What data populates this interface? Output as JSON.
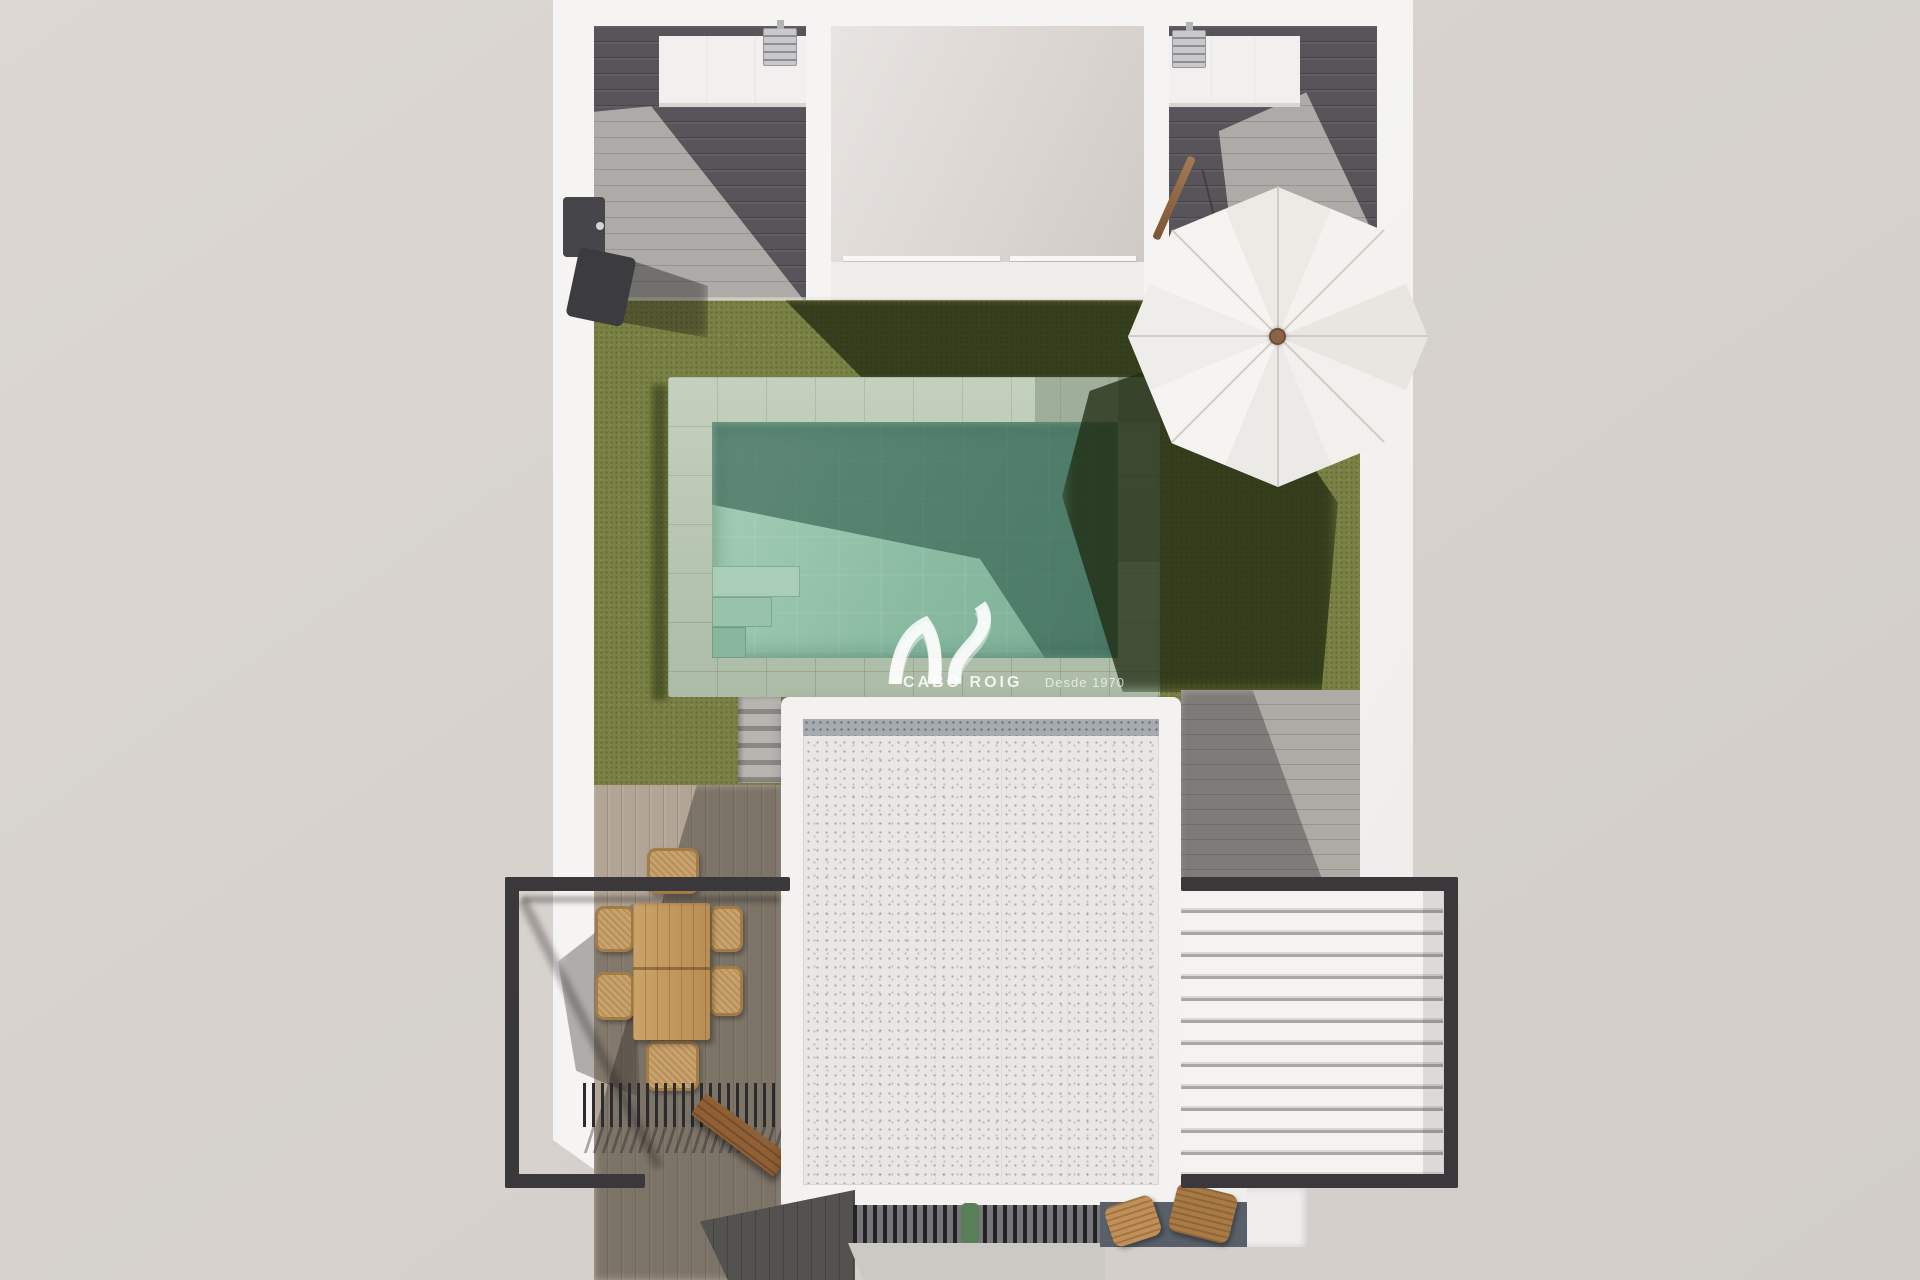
{
  "watermark": {
    "brand": "CABO ROIG",
    "tagline": "Desde 1970"
  },
  "scene": {
    "description": "Top-down 3D architectural render of a villa plot: U-shaped white building with roof decks, central courtyard, olive lawn with rectangular pool, white parasol, speckled rooftop, black glass railings, white louvered pergola, outdoor dining set, slatted grills and an outdoor shower",
    "objects": [
      "white-building-walls",
      "dark-wood-roof-deck-left",
      "dark-wood-roof-deck-right",
      "rooftop-counter-left",
      "rooftop-counter-right",
      "ac-unit-left",
      "ac-unit-right",
      "central-courtyard-terrace",
      "glass-parapet",
      "artificial-lawn",
      "swimming-pool",
      "pool-coping-tiles",
      "pool-corner-steps",
      "cantilever-parasol",
      "parasol-pole",
      "garden-stairs",
      "outdoor-shower",
      "lower-terrace-deck",
      "right-side-deck",
      "main-roof-gravel",
      "black-railing-left",
      "black-railing-right",
      "louvered-pergola",
      "dining-table",
      "wicker-chairs",
      "slatted-shade-grill",
      "wood-bench",
      "entrance-grate",
      "potted-plant",
      "concrete-apron",
      "dark-paving",
      "wood-loungers"
    ],
    "palette": {
      "background": "#d7d2ce",
      "wall_white": "#f3f2f0",
      "deck_dark": "#555357",
      "deck_light": "#a8a4a0",
      "terrace_wood": "#b0a494",
      "lawn_green": "#7a8144",
      "lawn_shadow": "#2a3512",
      "pool_coping": "#b6c6af",
      "pool_water_light": "#a6cfb8",
      "pool_water_dark": "#5d8f7c",
      "umbrella_white": "#f4f2ef",
      "roof_speckle": "#e9e7e4",
      "roof_band_gray": "#a6abb0",
      "railing_black": "#3a383a",
      "louver_white": "#f4f3f1",
      "table_wood": "#c59a62",
      "chair_wicker": "#c9a36b",
      "bench_wood": "#8a5c35",
      "paving_dark": "#59606a",
      "paving_light": "#ccc9c5",
      "plant_green": "#587f57",
      "hub_brown": "#8a6448"
    }
  }
}
